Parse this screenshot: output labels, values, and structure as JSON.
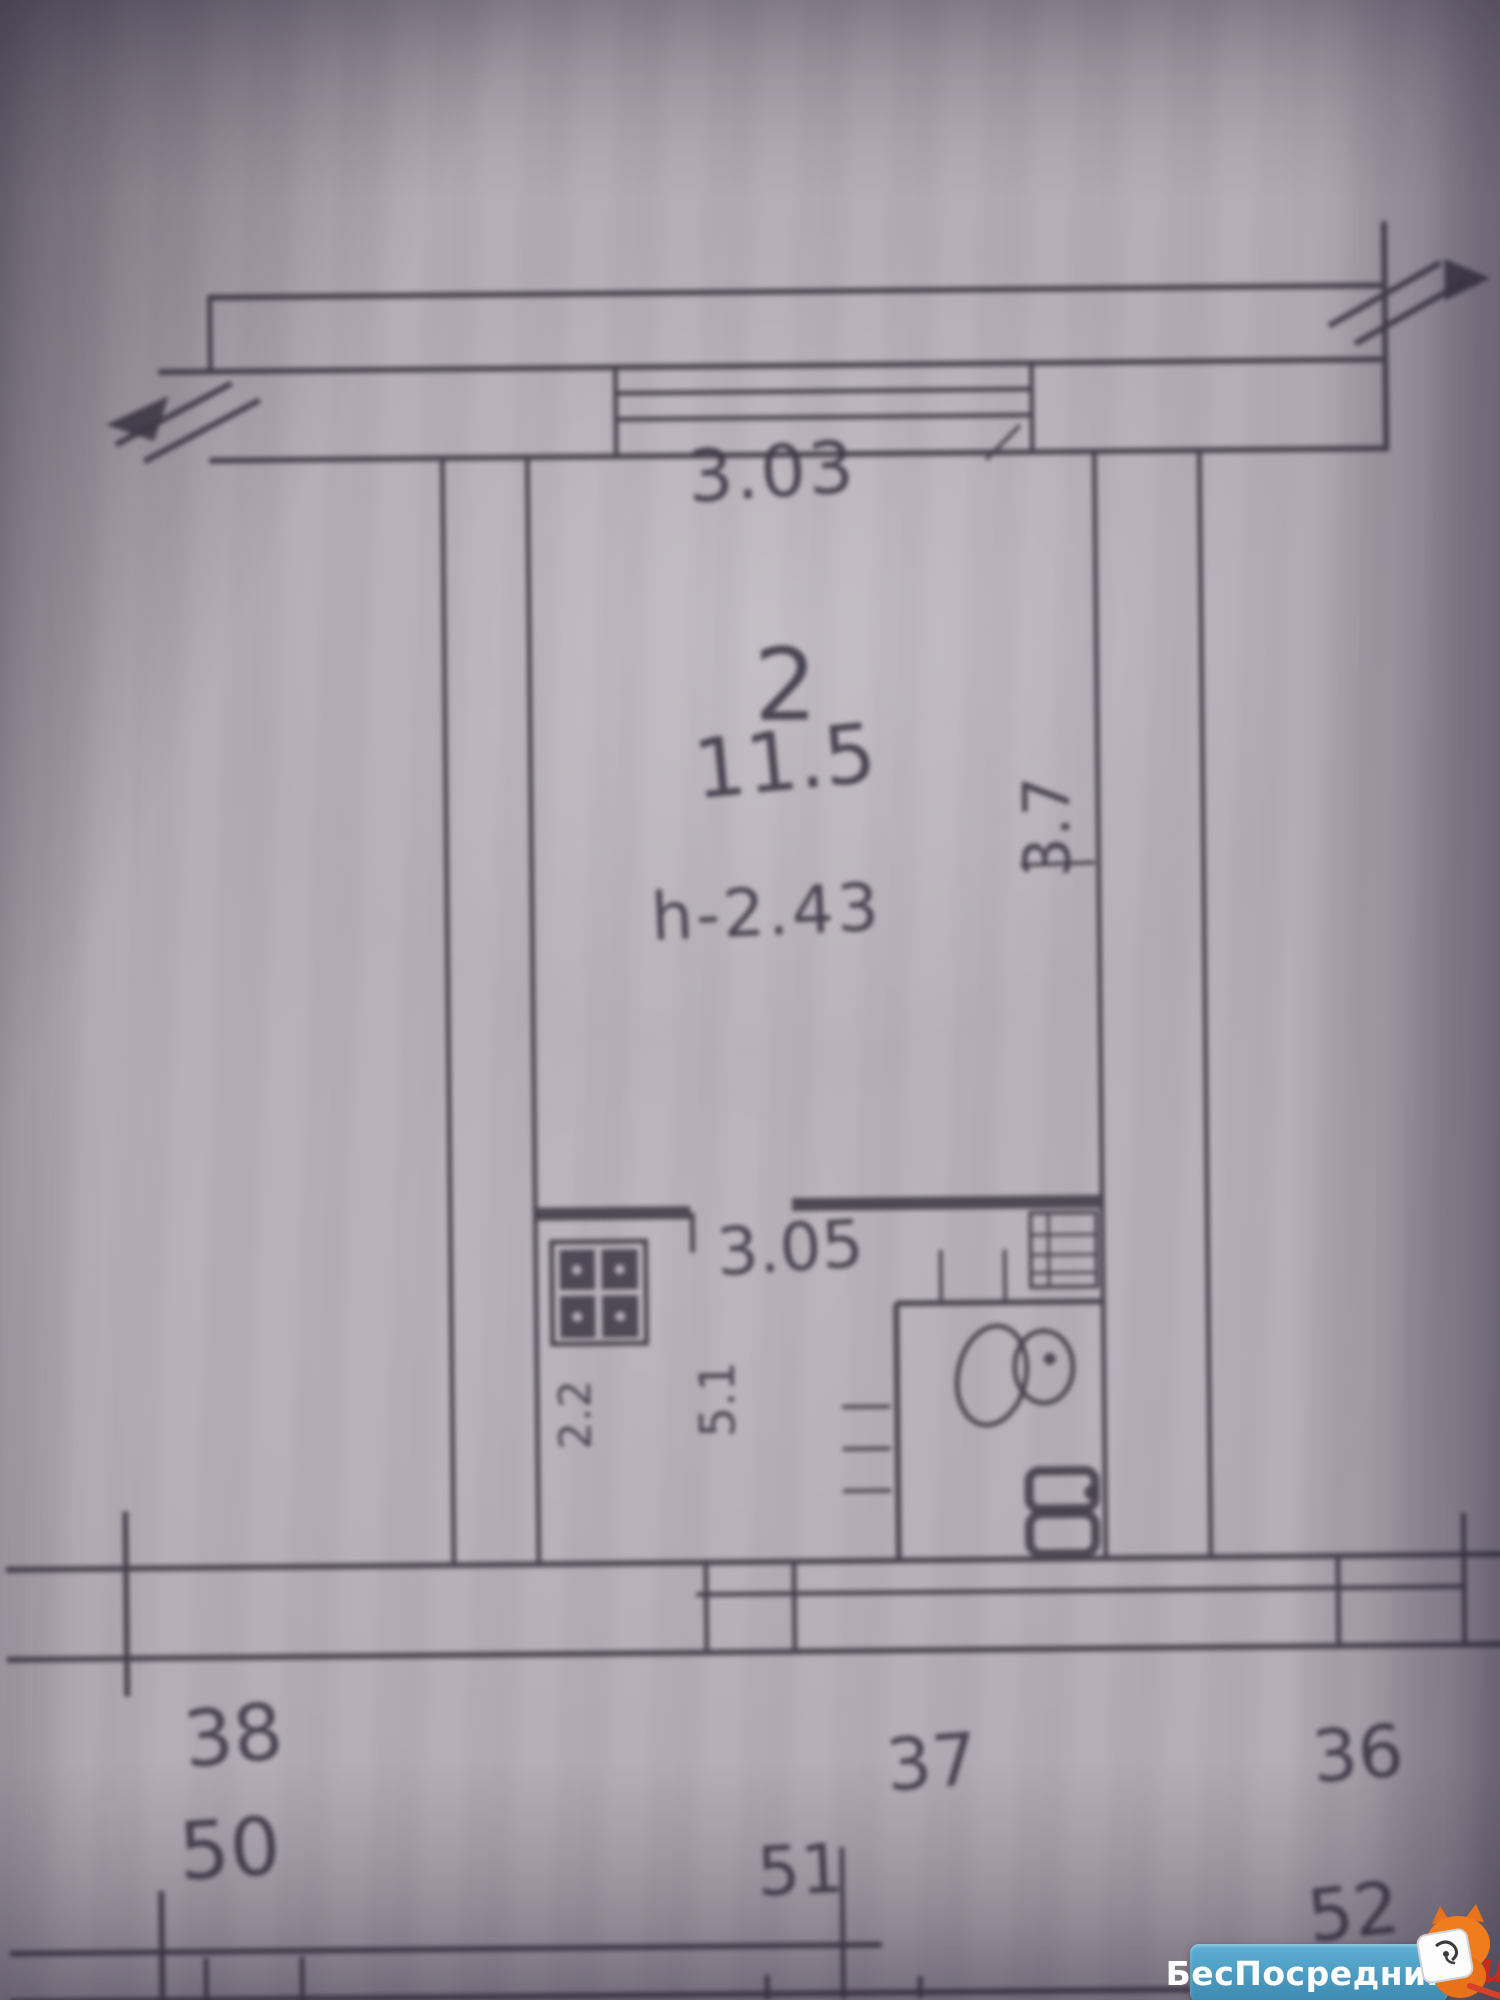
{
  "labels": {
    "top_width": "3.03",
    "room_number": "2",
    "room_area": "11.5",
    "ceiling_height": "h-2.43",
    "right_depth": "3.7",
    "inner_width": "3.05",
    "kitchen_depth": "2.2",
    "kitchen_area": "5.1",
    "unit_38": "38",
    "unit_37": "37",
    "unit_36": "36",
    "unit_50": "50",
    "unit_51": "51",
    "unit_52": "52"
  },
  "watermark": {
    "site_name": "БесПосредника",
    "suffix": ".ru"
  },
  "colors": {
    "paper": "#b4acb5",
    "ink": "#45404d",
    "watermark_blue": "#4491ba",
    "watermark_red": "#c92a1c",
    "mascot_orange": "#ef7d1d"
  }
}
